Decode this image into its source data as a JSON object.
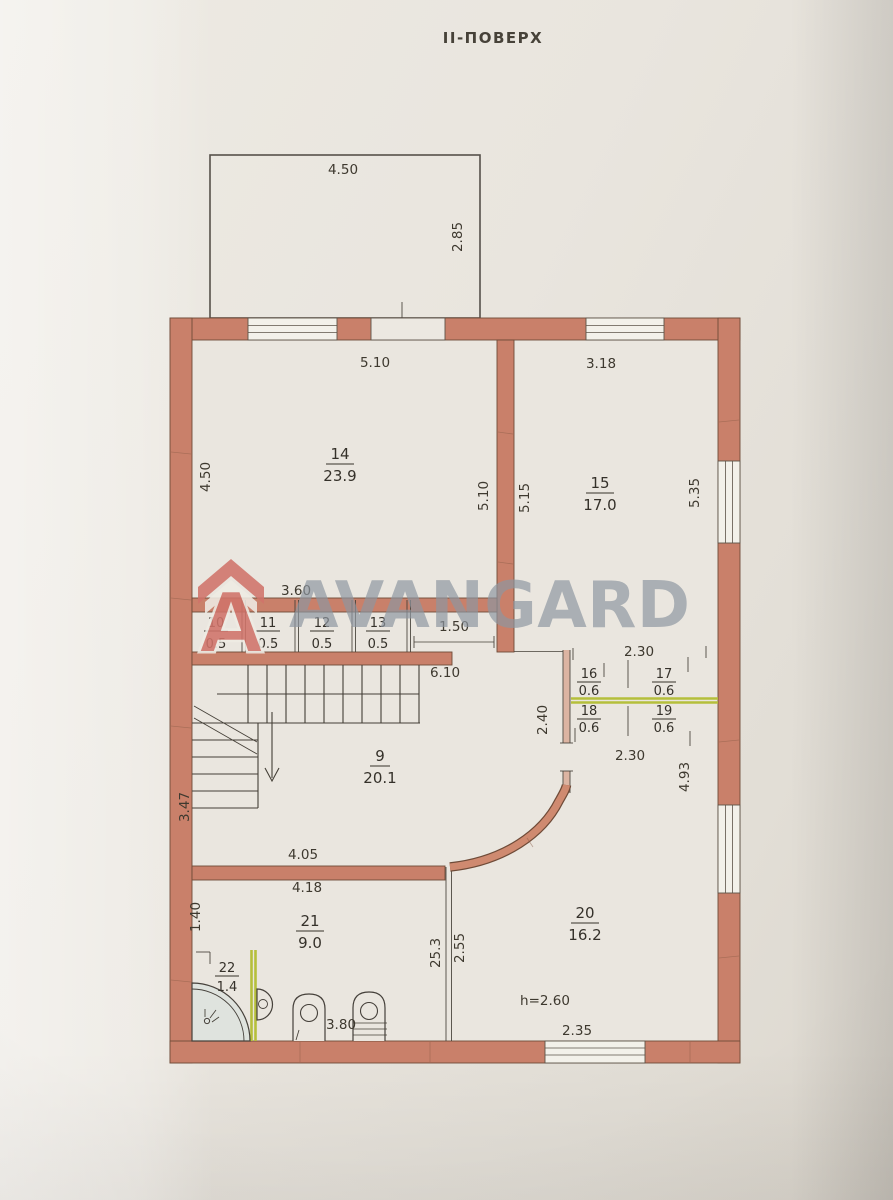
{
  "title": "ІІ-ПОВЕРХ",
  "watermark": {
    "brand": "AVANGARD",
    "logo_letter": "A"
  },
  "colors": {
    "wall": "#c9806a",
    "partition_accent": "#b5bf3b",
    "watermark_text": "#8d97a1",
    "logo": "#d0746a",
    "paper": "#e9e5de"
  },
  "balcony": {
    "width": "4.50",
    "depth": "2.85"
  },
  "corridor": {
    "dim_width": "3.60",
    "dim_passage": "1.50"
  },
  "block16_19": {
    "dim_top": "2.30",
    "dim_bottom": "2.30"
  },
  "rooms": {
    "r14": {
      "number": "14",
      "area": "23.9",
      "dim_top": "5.10",
      "dim_left": "4.50",
      "dim_right": "5.10"
    },
    "r15": {
      "number": "15",
      "area": "17.0",
      "dim_top": "3.18",
      "dim_left": "5.15",
      "dim_right": "5.35"
    },
    "r10": {
      "number": "10",
      "area": "0.5"
    },
    "r11": {
      "number": "11",
      "area": "0.5"
    },
    "r12": {
      "number": "12",
      "area": "0.5"
    },
    "r13": {
      "number": "13",
      "area": "0.5"
    },
    "r9": {
      "number": "9",
      "area": "20.1",
      "dim_top": "6.10",
      "dim_left": "3.47",
      "dim_bottom": "4.05",
      "dim_right": "2.40"
    },
    "r16": {
      "number": "16",
      "area": "0.6"
    },
    "r17": {
      "number": "17",
      "area": "0.6"
    },
    "r18": {
      "number": "18",
      "area": "0.6"
    },
    "r19": {
      "number": "19",
      "area": "0.6"
    },
    "r20": {
      "number": "20",
      "area": "16.2",
      "dim_right": "4.93",
      "dim_bottom": "2.35",
      "dim_left_outer": "25.3",
      "dim_left_inner": "2.55",
      "height_note": "h=2.60"
    },
    "r21": {
      "number": "21",
      "area": "9.0",
      "dim_top": "4.18",
      "dim_left": "1.40",
      "dim_bottom": "3.80"
    },
    "r22": {
      "number": "22",
      "area": "1.4"
    }
  }
}
